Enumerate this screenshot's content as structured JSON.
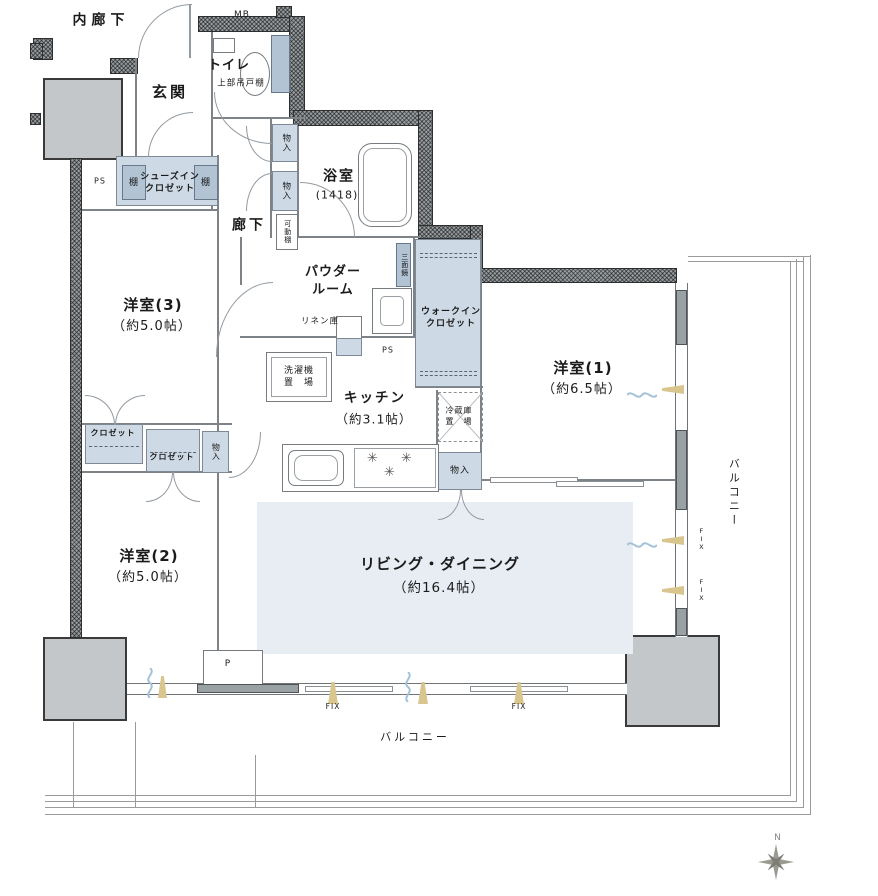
{
  "colors": {
    "closet_fill": "#cdd9e4",
    "closet_fill_dark": "#b2c3d3",
    "living_fill": "#e8edf3",
    "column_fill": "#c3c7c9",
    "window_marker_tan": "#d9c58e",
    "swing_mark_blue": "#a3c2d8"
  },
  "labels": {
    "inner_corridor": "内廊下",
    "mb": "MB",
    "entrance": "玄関",
    "toilet": "トイレ",
    "toilet_shelf": "上部吊戸棚",
    "shoes_closet": "シューズイン\nクロゼット",
    "shelf_left": "棚",
    "shelf_right": "棚",
    "ps_left": "PS",
    "ps_mid": "PS",
    "storage_hall_1": "物入",
    "storage_hall_2": "物入",
    "movable_shelf": "可動棚",
    "corridor": "廊下",
    "bathroom": "浴室",
    "bathroom_size": "(1418)",
    "powder_room": "パウダー\nルーム",
    "mirror": "三面鏡",
    "linen": "リネン庫",
    "washer": "洗濯機\n置　場",
    "walk_in_closet": "ウォークイン\nクロゼット",
    "kitchen": "キッチン",
    "kitchen_size": "（約3.1帖）",
    "fridge": "冷蔵庫\n置　場",
    "storage_kitchen": "物入",
    "room3": "洋室(3)",
    "room3_size": "（約5.0帖）",
    "closet_a": "クロゼット",
    "closet_b": "クロゼット",
    "storage_room2": "物入",
    "room2": "洋室(2)",
    "room2_size": "（約5.0帖）",
    "room1": "洋室(1)",
    "room1_size": "（約6.5帖）",
    "living": "リビング・ダイニング",
    "living_size": "（約16.4帖）",
    "balcony_right": "バルコニー",
    "balcony_bottom": "バルコニー",
    "fix_bottom_1": "FIX",
    "fix_bottom_2": "FIX",
    "fix_right_1": "FIX",
    "fix_right_2": "FIX",
    "p_mark": "P",
    "north": "N"
  }
}
